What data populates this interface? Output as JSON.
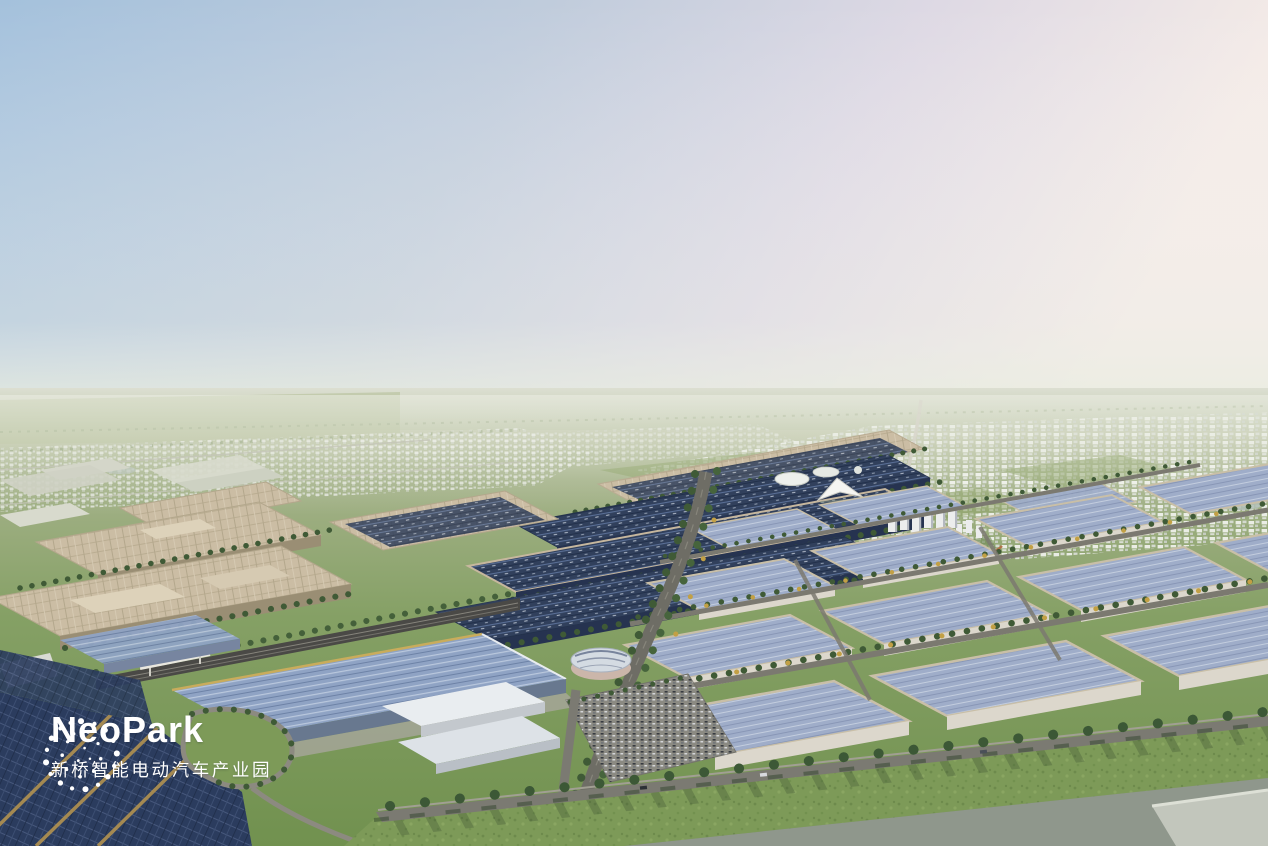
{
  "logo": {
    "brand": "NeoPark",
    "subtitle": "新桥智能电动汽车产业园",
    "mark": "dotted-sphere-logo",
    "color": "#ffffff"
  },
  "scene": {
    "type": "aerial-architectural-rendering",
    "palette": {
      "sky_blue": "#a4c1dc",
      "sky_pink": "#f4ebe7",
      "horizon_haze": "#e4e6da",
      "far_field": "#a9b68e",
      "field_green": "#85a065",
      "lawn_green": "#7d9a58",
      "tree_green": "#3f5a36",
      "tree_yellow": "#c2a045",
      "solar_navy": "#31405c",
      "solar_highlight": "#5d74a0",
      "workshop_blue": "#8fa3c4",
      "warehouse_blue": "#9fadc9",
      "roof_beige": "#cbbda4",
      "wall_white": "#dcd7cc",
      "road_grey": "#6e6d65",
      "rail_grey": "#4a4946",
      "gold_trim": "#b29250",
      "water_grey": "#8f978c",
      "logo_white": "#ffffff"
    }
  }
}
